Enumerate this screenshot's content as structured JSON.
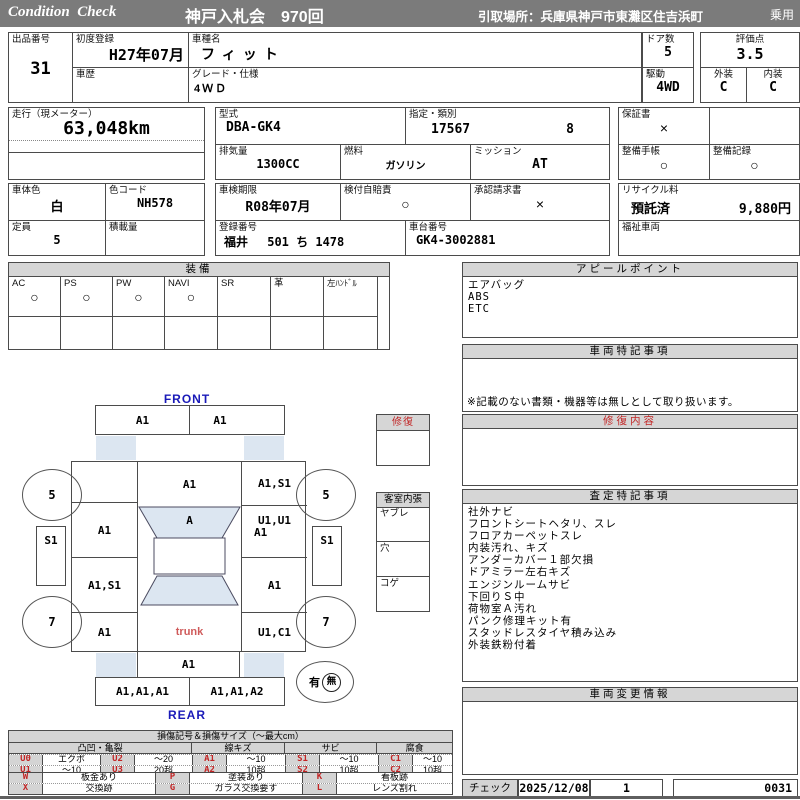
{
  "colors": {
    "header_bg": "#7b7b7b",
    "section_header_bg": "#d6d6d6",
    "glass_fill": "#dce6f1",
    "accent_blue": "#1a1ab8",
    "accent_red": "#c22525"
  },
  "header": {
    "brand": "Condition  Check",
    "title": "神戸入札会　970回",
    "pickup": "引取場所：兵庫県神戸市東灘区住吉浜町",
    "vehicle_class": "乗用"
  },
  "info": {
    "lot_label": "出品番号",
    "lot": "31",
    "first_reg_label": "初度登録",
    "first_reg": "H27年07月",
    "history_label": "車歴",
    "history": "",
    "model_name_label": "車種名",
    "model_name": "フィット",
    "grade_label": "グレード・仕様",
    "grade": "4ＷＤ",
    "doors_label": "ドア数",
    "doors": "5",
    "drive_label": "駆動",
    "drive": "4WD",
    "score_label": "評価点",
    "score": "3.5",
    "exterior_label": "外装",
    "exterior": "C",
    "interior_label": "内装",
    "interior": "C",
    "mileage_label": "走行（現メーター）",
    "mileage": "63,048km",
    "model_code_label": "型式",
    "model_code": "DBA-GK4",
    "class_label": "指定・類別",
    "class_no": "17567",
    "class_no2": "8",
    "warranty_label": "保証書",
    "warranty": "×",
    "displacement_label": "排気量",
    "displacement": "1300CC",
    "fuel_label": "燃料",
    "fuel": "ガソリン",
    "mission_label": "ミッション",
    "mission": "AT",
    "maintenance_book_label": "整備手帳",
    "maintenance_book": "○",
    "maintenance_record_label": "整備記録",
    "maintenance_record": "○",
    "color_label": "車体色",
    "body_color": "白",
    "color_code_label": "色コード",
    "color_code": "NH578",
    "capacity_label": "定員",
    "capacity": "5",
    "load_label": "積載量",
    "load": "",
    "inspection_label": "車検期限",
    "inspection": "R08年07月",
    "insurance_label": "検付自賠責",
    "insurance": "○",
    "approval_label": "承認請求書",
    "approval": "×",
    "recycle_label": "リサイクル料",
    "recycle_status": "預託済",
    "recycle_fee": "9,880円",
    "reg_no_label": "登録番号",
    "reg_no": "福井　 501 ち 1478",
    "chassis_label": "車台番号",
    "chassis": "GK4-3002881",
    "welfare_label": "福祉車両",
    "welfare": ""
  },
  "equipment": {
    "title": "装備",
    "items": [
      {
        "label": "AC",
        "mark": "○"
      },
      {
        "label": "PS",
        "mark": "○"
      },
      {
        "label": "PW",
        "mark": "○"
      },
      {
        "label": "NAVI",
        "mark": "○"
      },
      {
        "label": "SR",
        "mark": ""
      },
      {
        "label": "革",
        "mark": ""
      },
      {
        "label": "左ﾊﾝﾄﾞﾙ",
        "mark": ""
      }
    ]
  },
  "appeal": {
    "title": "アピールポイント",
    "items": [
      "エアバッグ",
      "ABS",
      "ETC"
    ]
  },
  "vehicle_notes": {
    "title": "車両特記事項",
    "note": "※記載のない書類・機器等は無しとして取り扱います。"
  },
  "repair_detail": {
    "title": "修復内容",
    "body": ""
  },
  "assessment": {
    "title": "査定特記事項",
    "items": [
      "社外ナビ",
      "フロントシートヘタリ、スレ",
      "フロアカーペットスレ",
      "内装汚れ、キズ",
      "アンダーカバー１部欠損",
      "ドアミラー左右キズ",
      "エンジンルームサビ",
      "下回りＳ中",
      "荷物室Ａ汚れ",
      "パンク修理キット有",
      "スタッドレスタイヤ積み込み",
      "外装鉄粉付着"
    ]
  },
  "change_info": {
    "title": "車両変更情報",
    "body": ""
  },
  "check": {
    "label": "チェック",
    "date": "2025/12/08",
    "count": "1",
    "number": "0031"
  },
  "side_boxes": {
    "repair": "修復",
    "interior_title": "客室内張",
    "interior_rows": [
      "ヤブレ",
      "穴",
      "コゲ"
    ]
  },
  "damage_map": {
    "front_label": "FRONT",
    "rear_label": "REAR",
    "trunk_label": "trunk",
    "hood_left": "A1",
    "hood_right": "A1",
    "roof_front": "A1",
    "windshield": "A",
    "left_col_0": "",
    "left_col_1": "A1",
    "left_col_2": "A1,S1",
    "left_col_3": "A1",
    "right_col_0": "A1,S1",
    "right_col_1a": "U1,U1",
    "right_col_1b": "A1",
    "right_col_2": "A1",
    "right_col_3": "U1,C1",
    "wheel_front_left": "5",
    "wheel_front_right": "5",
    "wheel_rear_left": "7",
    "wheel_rear_right": "7",
    "mirror_left": "S1",
    "mirror_right": "S1",
    "tailgate": "A1",
    "bumper_left": "A1,A1,A1",
    "bumper_right": "A1,A1,A2",
    "presence_yes": "有",
    "presence_no": "無"
  },
  "legend": {
    "title": "損傷記号＆損傷サイズ（〜最大cm）",
    "groups": [
      "凸凹・亀裂",
      "線キズ",
      "サビ",
      "腐食"
    ],
    "rows": [
      [
        "U0",
        "エクボ",
        "U2",
        "〜20",
        "A1",
        "〜10",
        "S1",
        "〜10",
        "C1",
        "〜10"
      ],
      [
        "U1",
        "〜10",
        "U3",
        "20超",
        "A2",
        "10超",
        "S2",
        "10超",
        "C2",
        "10超"
      ]
    ],
    "rows2": [
      [
        "W",
        "板金あり",
        "P",
        "塗装あり",
        "K",
        "看板跡"
      ],
      [
        "X",
        "交換跡",
        "G",
        "ガラス交換要す",
        "L",
        "レンズ割れ"
      ]
    ]
  }
}
